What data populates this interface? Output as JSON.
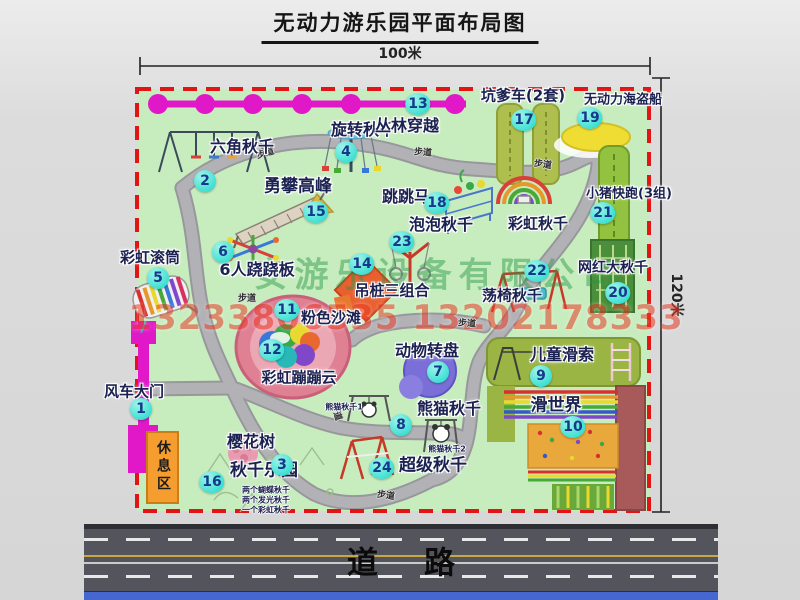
{
  "title": "无动力游乐园平面布局图",
  "scale": {
    "top": "100米",
    "right": "120米"
  },
  "road": {
    "label": "道路"
  },
  "watermark": {
    "company": "安游乐设备有限公司",
    "phone": "13233806535 13202178333"
  },
  "map": {
    "rest_area": "休息区",
    "path_label": "步道",
    "attractions": [
      {
        "num": "1",
        "name": "风车大门"
      },
      {
        "num": "2",
        "name": "六角秋千"
      },
      {
        "num": "3",
        "name": "樱花树"
      },
      {
        "num": "4",
        "name": "旋转秋千"
      },
      {
        "num": "5",
        "name": "彩虹滚筒"
      },
      {
        "num": "6",
        "name": "6人跷跷板"
      },
      {
        "num": "7",
        "name": "动物转盘"
      },
      {
        "num": "8",
        "name": "熊猫秋千"
      },
      {
        "num": "9",
        "name": "儿童滑索"
      },
      {
        "num": "10",
        "name": "滑世界"
      },
      {
        "num": "11",
        "name": "粉色沙滩"
      },
      {
        "num": "12",
        "name": "彩虹蹦蹦云"
      },
      {
        "num": "13",
        "name": "丛林穿越"
      },
      {
        "num": "14",
        "name": "吊桩三组合"
      },
      {
        "num": "15",
        "name": "勇攀高峰"
      },
      {
        "num": "16",
        "name": "秋千乐园"
      },
      {
        "num": "17",
        "name": "坑爹车(2套)"
      },
      {
        "num": "18",
        "name": "跳跳马"
      },
      {
        "num": "19",
        "name": "无动力海盗船"
      },
      {
        "num": "20",
        "name": "网红大秋千"
      },
      {
        "num": "21",
        "name": "小猪快跑(3组)"
      },
      {
        "num": "22",
        "name": "荡椅秋千"
      },
      {
        "num": "23",
        "name": "泡泡秋千"
      },
      {
        "num": "24",
        "name": "超级秋千"
      }
    ],
    "extra_labels": {
      "rainbow_swing": "彩虹秋千",
      "panda_swing_1": "熊猫秋千1",
      "panda_swing_2": "熊猫秋千2",
      "swing_park_notes": [
        "两个蝴蝶秋千",
        "两个发光秋千",
        "一个彩虹秋千"
      ]
    }
  },
  "colors": {
    "map-green": "#c7ecbe",
    "border-red": "#e31414",
    "badge-cyan": "#3adfd2",
    "badge-ink": "#16398a",
    "magenta": "#e018c8",
    "path-gray": "#b2b2b6",
    "path-edge": "#97979c",
    "label-ink": "#1b2150",
    "orange": "#f59d2f",
    "road-gray": "#54545c",
    "road-blue": "#4567cf",
    "watermark-green": "#239646",
    "watermark-red": "#eb3c28"
  }
}
